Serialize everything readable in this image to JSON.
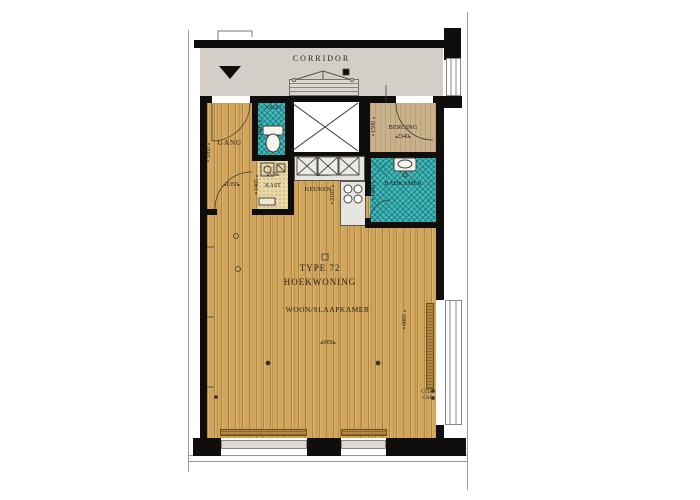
{
  "plan": {
    "corridor": {
      "label": "CORRIDOR"
    },
    "rooms": {
      "gang": {
        "label": "GANG",
        "dim_w": "1350",
        "dim_h": "3000"
      },
      "toilet": {
        "label": "TOILET",
        "dim_h": "1485"
      },
      "kast": {
        "label": "KAST",
        "dim_w": "920",
        "dim_h": "1465"
      },
      "keuken": {
        "label": "KEUKEN",
        "dim_w": "2130",
        "dim_h": "2105"
      },
      "berging": {
        "label": "BERGING",
        "dim_w": "2340",
        "dim_h": "1500"
      },
      "badkamer": {
        "label": "BADKAMER",
        "dim_h": "1400"
      },
      "living": {
        "type_line": "TYPE 72",
        "name_line": "HOEKWONING",
        "label": "WOON/SLAAPKAMER",
        "dim_w": "6950",
        "dim_h": "6865"
      }
    },
    "annotations": {
      "ctd": "CTD",
      "cai": "CAI"
    },
    "colors": {
      "wood": "#d1a65c",
      "tile": "#41b9ba",
      "corridor": "#d3cfc8",
      "berging_floor": "#c9b28b",
      "kast_floor": "#e7d8a6",
      "wall": "#0f0e0d",
      "counter": "#e7e5e0"
    }
  }
}
